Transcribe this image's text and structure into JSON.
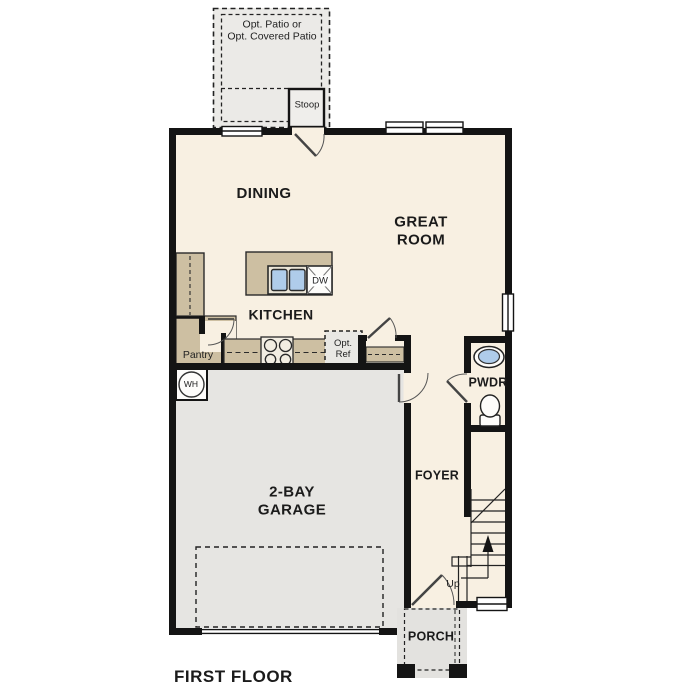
{
  "plan": {
    "title": "FIRST FLOOR",
    "rooms": {
      "dining": "DINING",
      "great_room": "GREAT\nROOM",
      "kitchen": "KITCHEN",
      "garage": "2-BAY\nGARAGE",
      "foyer": "FOYER",
      "powder": "PWDR",
      "porch": "PORCH",
      "pantry": "Pantry"
    },
    "annotations": {
      "patio": "Opt. Patio or\nOpt. Covered Patio",
      "stoop": "Stoop",
      "opt_ref": "Opt.\nRef",
      "dishwasher": "DW",
      "water_heater": "WH",
      "stairs_up": "Up"
    },
    "colors": {
      "wall": "#141414",
      "interior_floor": "#f8f0e2",
      "garage_floor": "#e6e5e2",
      "patio_floor": "#ebeae7",
      "porch_floor": "#e3e2df",
      "cabinet_tan": "#cdbfa2",
      "sink_blue": "#afccea",
      "line": "#2a2a2a"
    }
  }
}
